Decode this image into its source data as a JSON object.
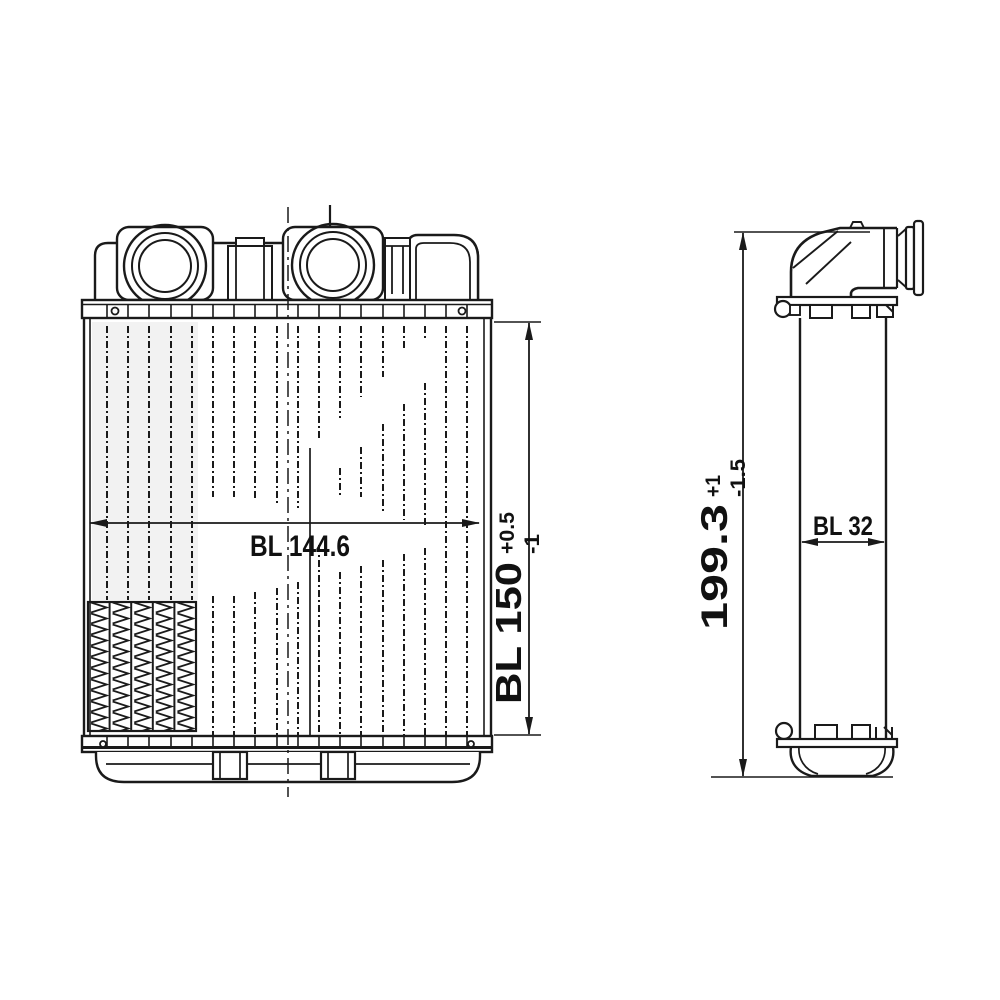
{
  "drawing": {
    "type": "technical-drawing",
    "subject": "heater-core-two-views",
    "colors": {
      "ink": "#1a1a1a",
      "background": "#ffffff"
    }
  },
  "front_view": {
    "width_dimension": {
      "label": "BL 144.6"
    },
    "height_dimension": {
      "label": "BL 150",
      "tolerance_plus": "+0.5",
      "tolerance_minus": "-1"
    }
  },
  "side_view": {
    "height_dimension": {
      "label": "199.3",
      "tolerance_plus": "+1",
      "tolerance_minus": "-1.5"
    },
    "depth_dimension": {
      "label": "BL 32"
    }
  }
}
